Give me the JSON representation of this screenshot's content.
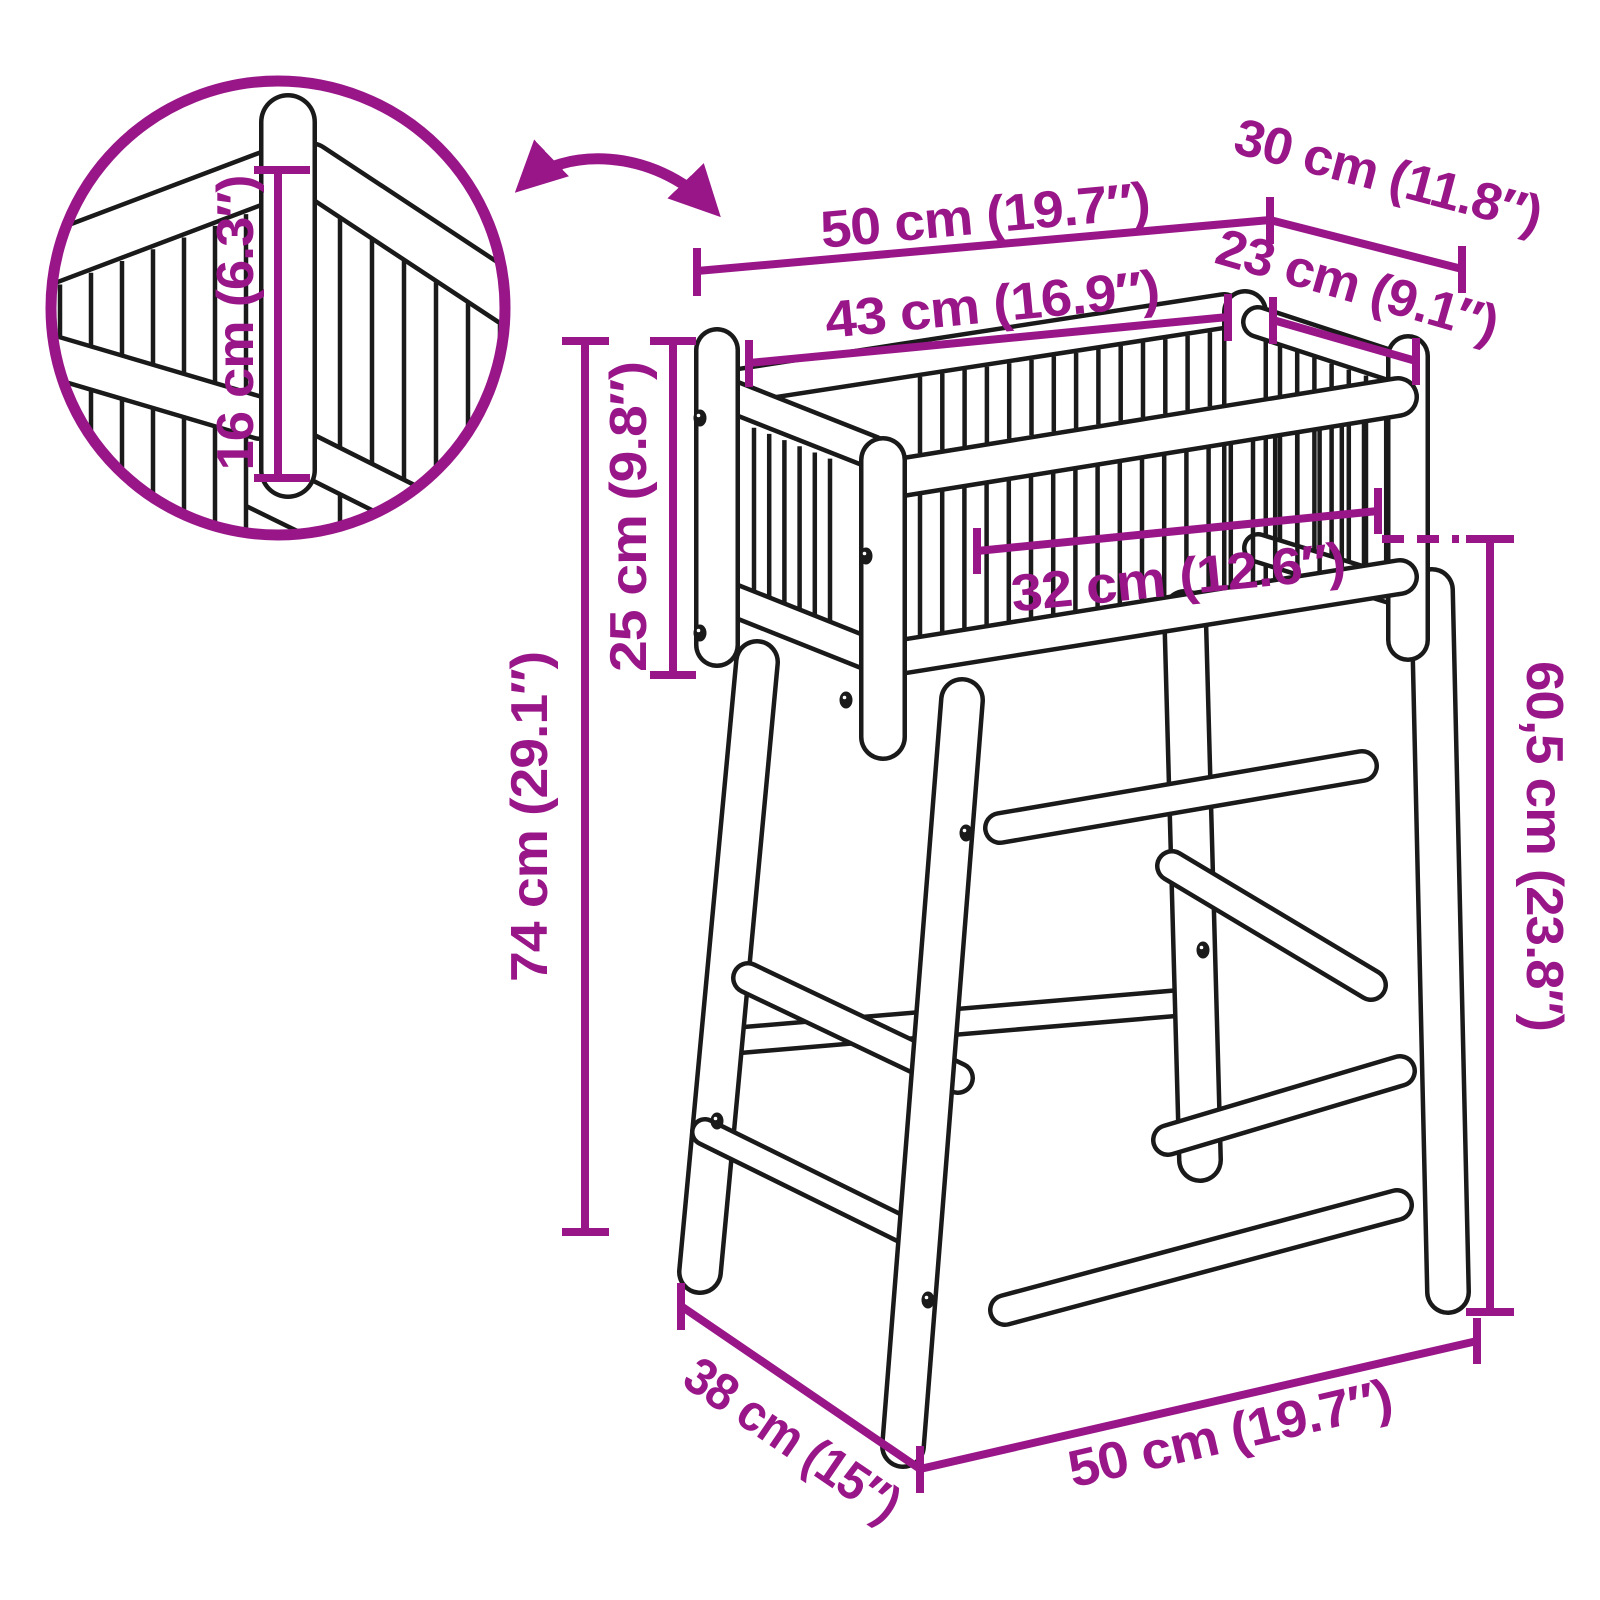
{
  "diagram_title": "planter-stand-dimension-diagram",
  "colors": {
    "dimension_accent": "#991689",
    "line_art": "#1a1a1a",
    "background": "#ffffff"
  },
  "dimensions": {
    "top_width": "50 cm (19.7″)",
    "top_depth": "30 cm (11.8″)",
    "inner_width": "43 cm (16.9″)",
    "inner_depth": "23 cm (9.1″)",
    "box_height": "25 cm (9.8″)",
    "total_height": "74 cm (29.1″)",
    "detail_height": "16 cm (6.3″)",
    "inner_opening": "32 cm (12.6″)",
    "leg_height": "60,5 cm (23.8″)",
    "base_depth": "38 cm (15″)",
    "base_width": "50 cm (19.7″)"
  }
}
